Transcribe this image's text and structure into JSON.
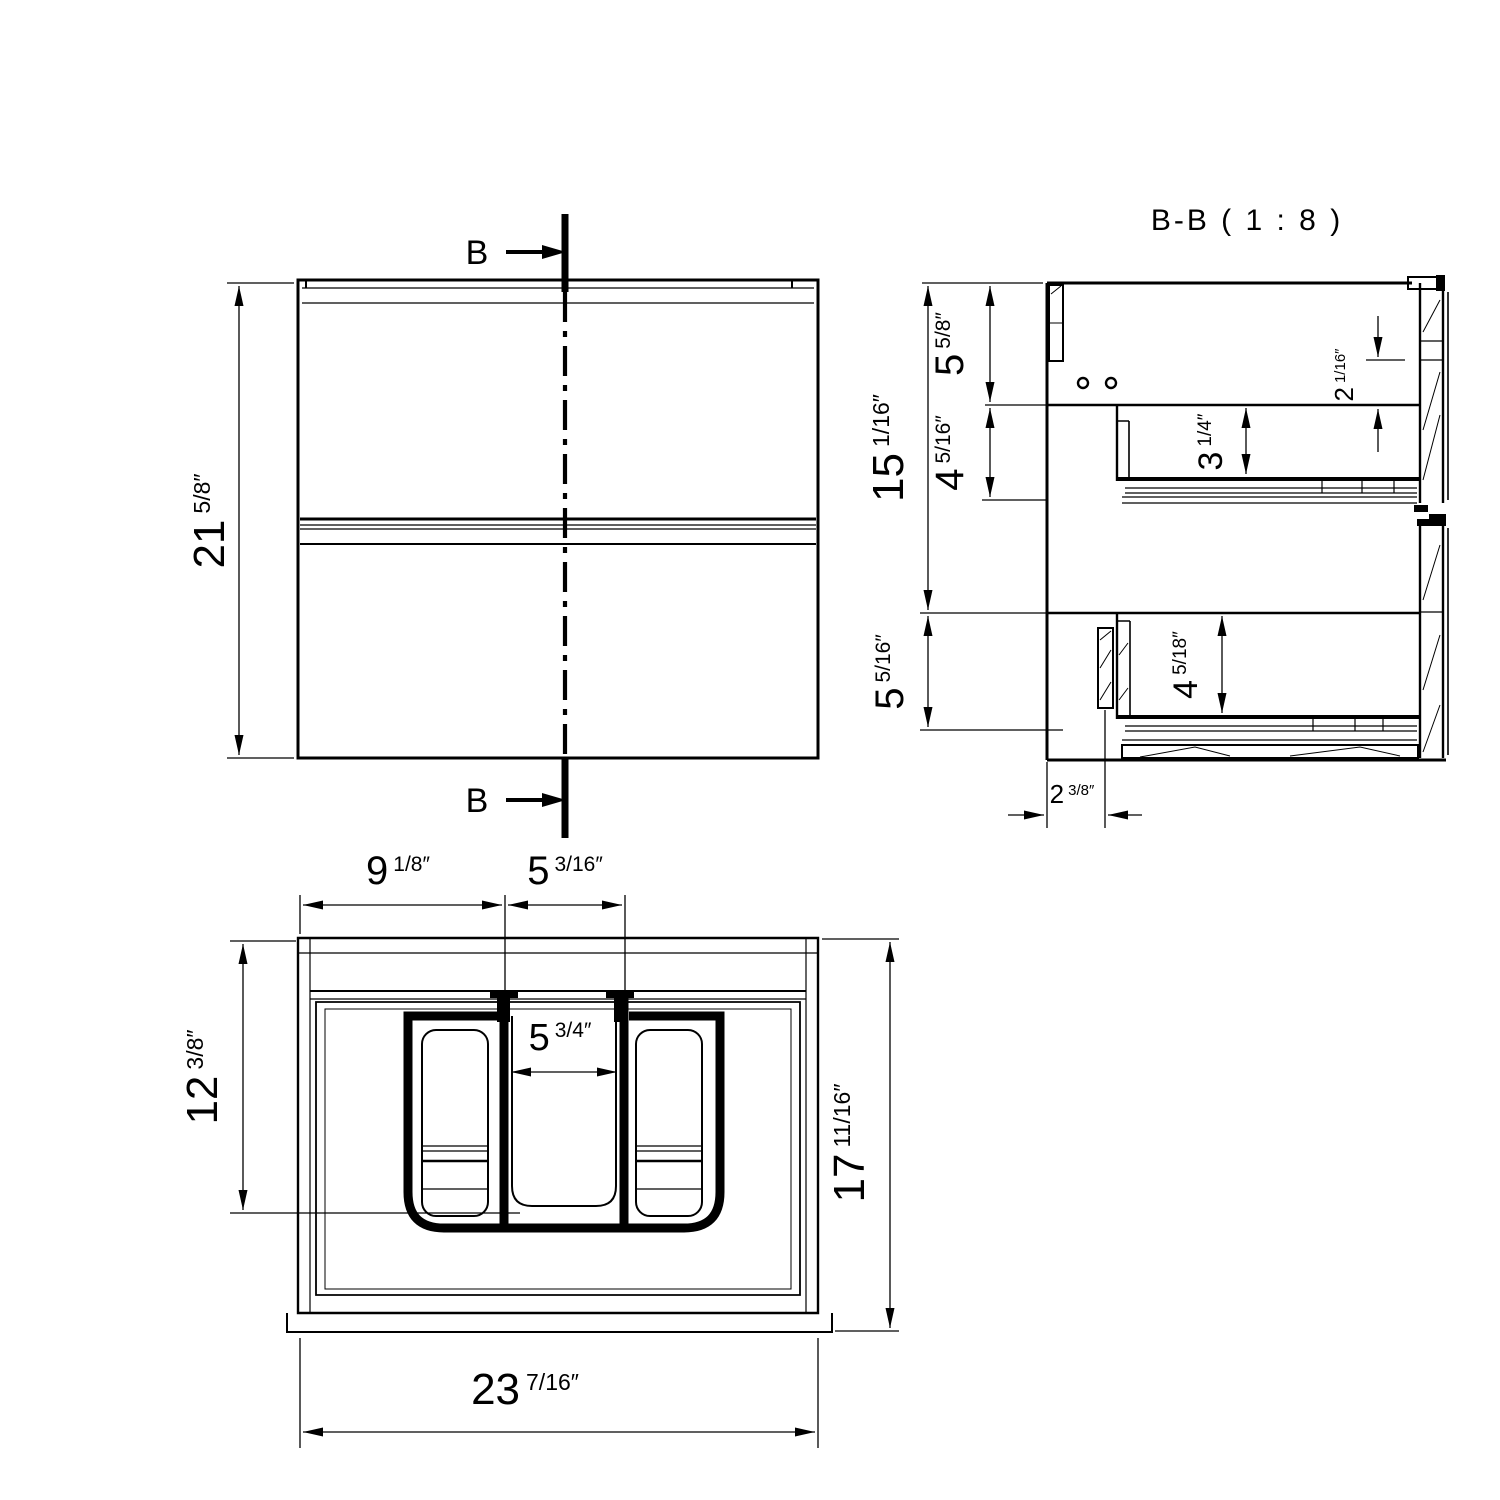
{
  "drawing": {
    "section_view_title": "B-B ( 1 : 8 )",
    "section_marker": {
      "top_label": "B",
      "bottom_label": "B"
    }
  },
  "dims": {
    "front_height": {
      "whole": "21",
      "frac": "5/8″"
    },
    "sec_upper_total": {
      "whole": "15",
      "frac": "1/16″"
    },
    "sec_top_gap": {
      "whole": "5",
      "frac": "5/8″"
    },
    "sec_drawer1": {
      "whole": "4",
      "frac": "5/16″"
    },
    "sec_lower": {
      "whole": "5",
      "frac": "5/16″"
    },
    "sec_d1_inner": {
      "whole": "3",
      "frac": "1/4″"
    },
    "sec_reveal": {
      "whole": "2",
      "frac": "1/16″"
    },
    "sec_d2_inner": {
      "whole": "4",
      "frac": "5/18″"
    },
    "sec_bottom_inset": {
      "whole": "2",
      "frac": "3/8″"
    },
    "plan_left": {
      "whole": "9",
      "frac": "1/8″"
    },
    "plan_mid": {
      "whole": "5",
      "frac": "3/16″"
    },
    "plan_bowl": {
      "whole": "5",
      "frac": "3/4″"
    },
    "plan_depth_inner": {
      "whole": "12",
      "frac": "3/8″"
    },
    "plan_depth": {
      "whole": "17",
      "frac": "11/16″"
    },
    "plan_width": {
      "whole": "23",
      "frac": "7/16″"
    }
  }
}
